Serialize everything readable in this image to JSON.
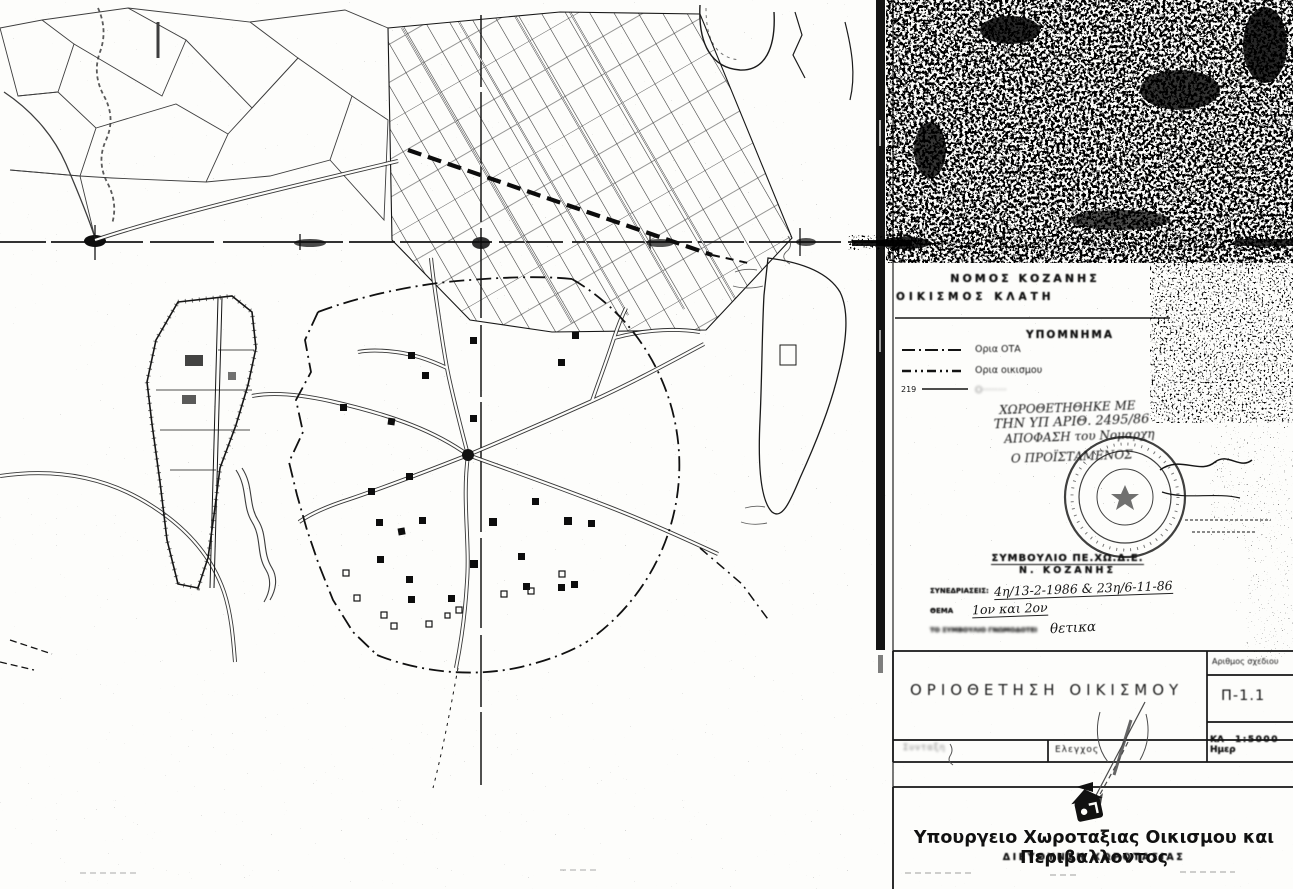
{
  "page": {
    "paper": "#fdfdfb",
    "ink": "#141414",
    "pencil": "#4a4a4a"
  },
  "map_header": {
    "prefecture": "ΝΟΜΟΣ ΚΟΖΑΝΗΣ",
    "settlement": "ΟΙΚΙΣΜΟΣ  ΚΛΑΤΗ"
  },
  "legend": {
    "title": "ΥΠΟΜΝΗΜΑ",
    "items": [
      {
        "symbol": "dash-dot-line",
        "symbol_text": "",
        "label": "Ορια ΟΤΑ"
      },
      {
        "symbol": "dash-dot-dot-line",
        "symbol_text": "",
        "label": "Ορια οικισμου"
      },
      {
        "symbol": "numbered-line",
        "symbol_text": "219",
        "label": "Ο········"
      }
    ]
  },
  "approval_note": {
    "line1": "ΧΩΡΟΘΕΤΗΘΗΚΕ ΜΕ",
    "line2": "ΤΗΝ ΥΠ ΑΡΙΘ. 2495/86",
    "line3": "ΑΠΟΦΑΣΗ του Νομαρχη",
    "line4": "Ο ΠΡΟΪΣΤΑΜΕΝΟΣ"
  },
  "council_stamp": {
    "line1": "ΣΥΜΒΟΥΛΙΟ ΠΕ.ΧΩ.Δ.Ε.",
    "line2": "Ν. ΚΟΖΑΝΗΣ",
    "sessions_label": "ΣΥΝΕΔΡΙΑΣΕΙΣ:",
    "sessions_value": "4η/13-2-1986 & 23η/6-11-86",
    "topic_label": "ΘΕΜΑ",
    "topic_value": "1ον και 2ον",
    "verdict_label": "ΤΟ ΣΥΜΒΟΥΛΙΟ ΓΝΩΜΟΔΟΤΕΙ",
    "verdict_value": "θετικα"
  },
  "title_block": {
    "title": "ΟΡΙΟΘΕΤΗΣΗ  ΟΙΚΙΣΜΟΥ",
    "drawing_no_label": "Αριθμος σχεδιου",
    "drawing_no": "Π-1.1",
    "scale_label": "ΚΛ",
    "scale": "1:5000",
    "date_label": "Ημερ",
    "drafting_label": "Συνταξη",
    "check_label": "Ελεγχος"
  },
  "footer": {
    "ministry": "Υπουργειο Χωροταξιας Οικισμου και Περιβαλλοντος",
    "directorate": "ΔΙΕΥΘΥΝΣΗ ΧΩΡΟΤΑΞΙΑΣ"
  }
}
